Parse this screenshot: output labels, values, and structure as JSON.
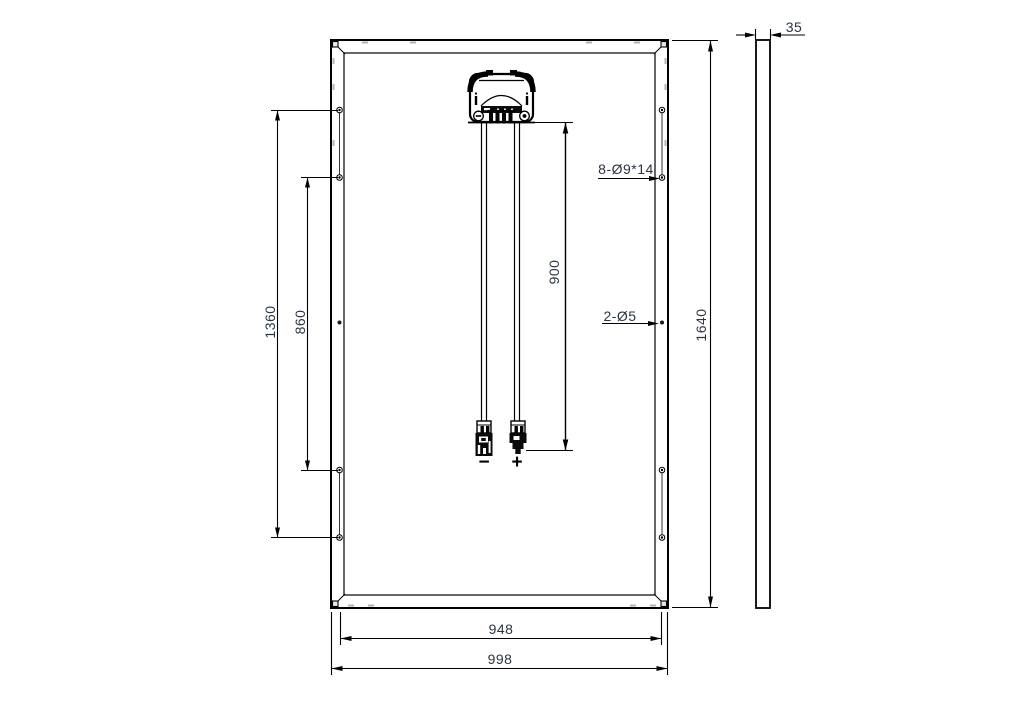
{
  "drawing": {
    "title": "solar-panel-rear-view-dimension-drawing",
    "dimensions": {
      "overall_width": "998",
      "mounting_width": "948",
      "overall_height": "1640",
      "hole_pitch_long": "1360",
      "hole_pitch_short": "860",
      "cable_length": "900",
      "thickness": "35"
    },
    "annotations": {
      "mounting_hole_spec": "8-Ø9*14",
      "grounding_hole_spec": "2-Ø5",
      "negative_label": "−",
      "positive_label": "+"
    }
  }
}
